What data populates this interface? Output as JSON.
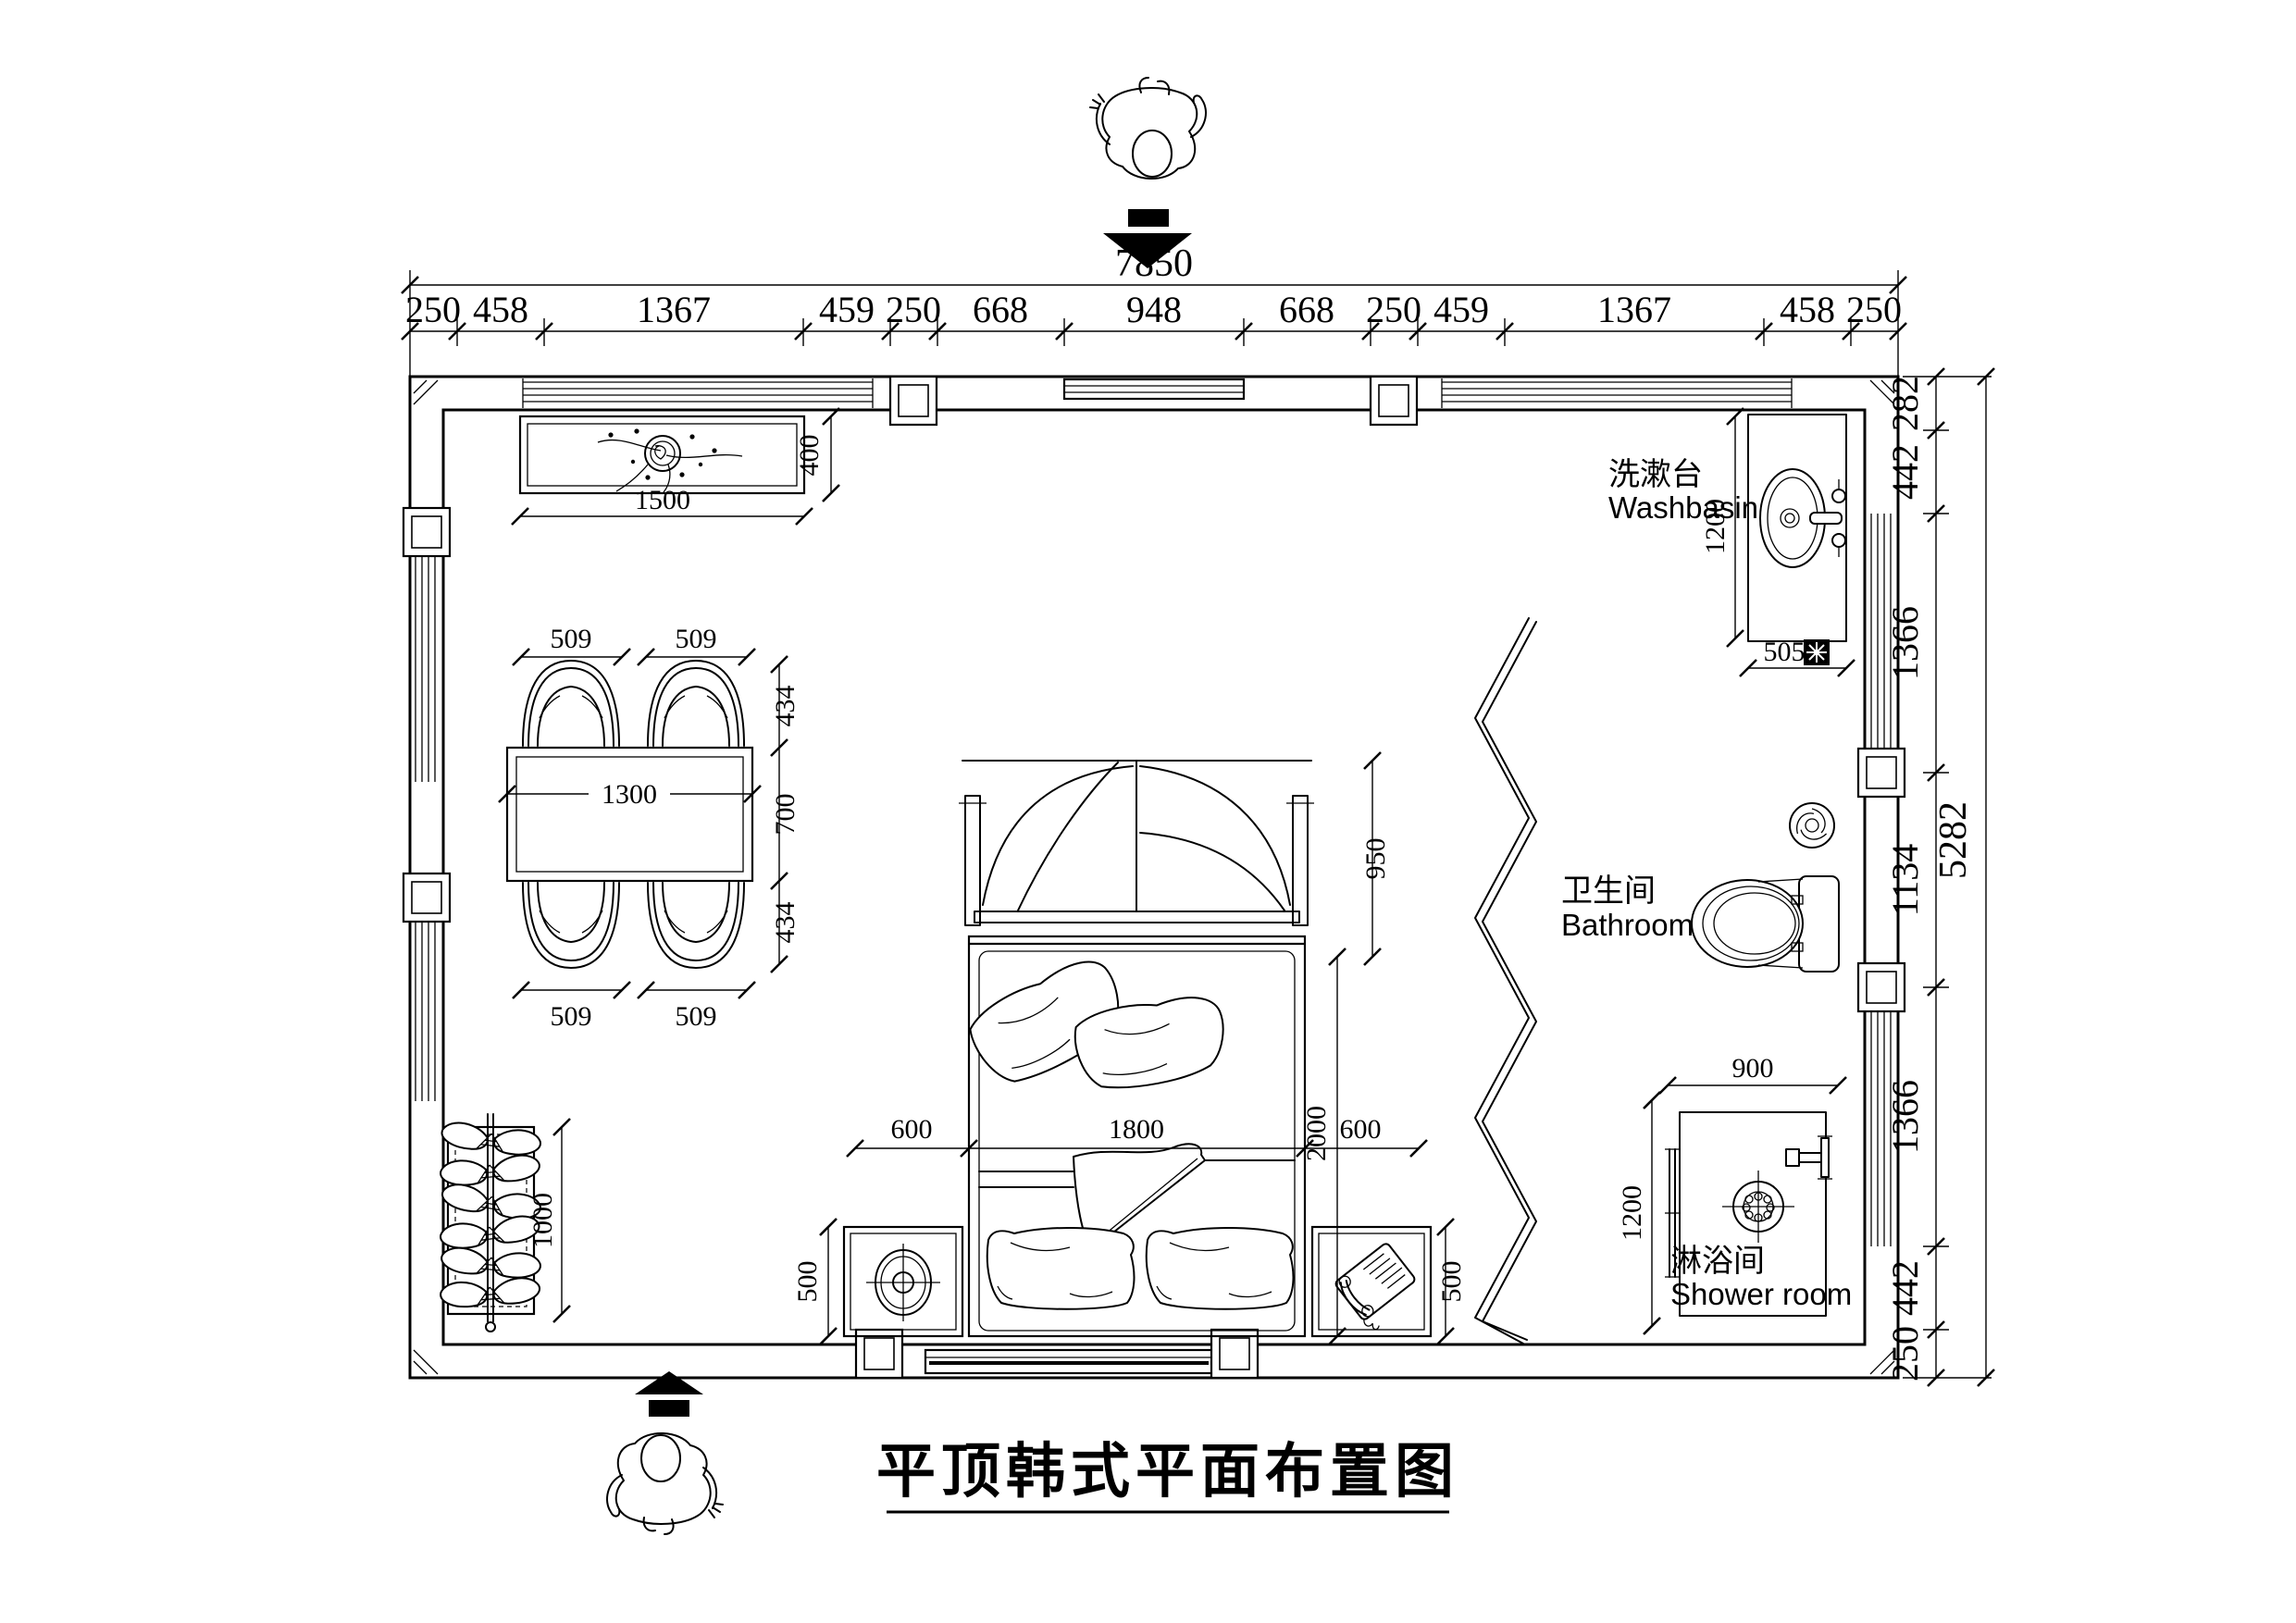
{
  "title": "平顶韩式平面布置图",
  "dimensions": {
    "top": {
      "total": "7850",
      "segments": [
        "250",
        "458",
        "1367",
        "459",
        "250",
        "668",
        "948",
        "668",
        "250",
        "459",
        "1367",
        "458",
        "250"
      ]
    },
    "right": {
      "total": "5282",
      "segments": [
        "282",
        "442",
        "1366",
        "1134",
        "1366",
        "442",
        "250"
      ]
    }
  },
  "rooms": {
    "washbasin": {
      "label_zh": "洗漱台",
      "label_en": "Washbasin",
      "depth": "1200",
      "counter_width": "505"
    },
    "bathroom": {
      "label_zh": "卫生间",
      "label_en": "Bathroom"
    },
    "shower": {
      "label_zh": "淋浴间",
      "label_en": "Shower room",
      "width": "900",
      "depth": "1200"
    }
  },
  "furniture": {
    "tv_cabinet": {
      "width": "1500",
      "depth": "400"
    },
    "dining_table": {
      "length": "1300",
      "depth": "700",
      "chair_top": [
        "509",
        "509"
      ],
      "chair_bottom": [
        "509",
        "509"
      ],
      "side": [
        "434",
        "700",
        "434"
      ]
    },
    "bed": {
      "left_gap": "600",
      "width": "1800",
      "right_gap": "600",
      "length": "2000",
      "canopy_depth": "950",
      "nightstand_left": "500",
      "nightstand_right": "500"
    },
    "wardrobe": {
      "length": "1000"
    }
  },
  "colors": {
    "ink": "#000000",
    "paper": "#ffffff"
  }
}
